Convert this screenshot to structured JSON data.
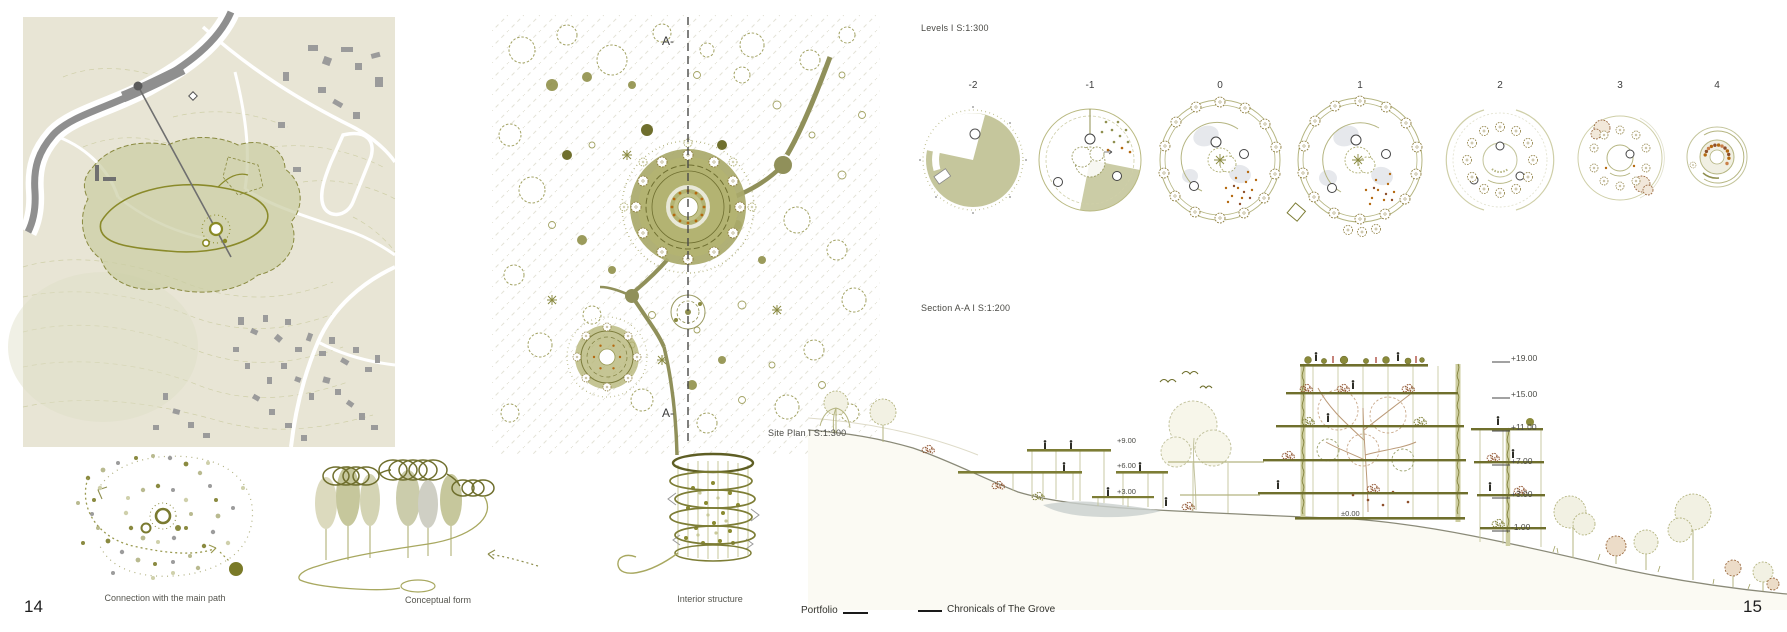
{
  "pages": {
    "left_number": "14",
    "right_number": "15"
  },
  "footer": {
    "left_label": "Portfolio",
    "right_label": "Chronicals of The Grove"
  },
  "left_page": {
    "site_plan": {
      "caption": "Site Plan I S:1:300",
      "marker_top": "A-",
      "marker_bottom": "A-"
    },
    "diagrams": {
      "connection_caption": "Connection with the main path",
      "form_caption": "Conceptual form",
      "structure_caption": "Interior structure"
    }
  },
  "right_page": {
    "levels": {
      "title": "Levels I S:1:300",
      "labels": [
        "-2",
        "-1",
        "0",
        "1",
        "2",
        "3",
        "4"
      ]
    },
    "section": {
      "title": "Section A-A I S:1:200",
      "elevations_right": [
        "+19.00",
        "+15.00",
        "+11.00",
        "+7.00",
        "+3.00",
        "-1.00"
      ],
      "elevations_left": [
        "+9.00",
        "+6.00",
        "+3.00"
      ],
      "ground_marker": "±0.00"
    }
  },
  "colors": {
    "olive_dark": "#6f6f2d",
    "olive": "#8f8f4f",
    "olive_fill": "#c5c69c",
    "sage_beige": "#e8e5d5",
    "gray": "#8f8f8f",
    "orange": "#b4690f",
    "rust": "#8d4f2a",
    "ink": "#3f3f3f"
  }
}
